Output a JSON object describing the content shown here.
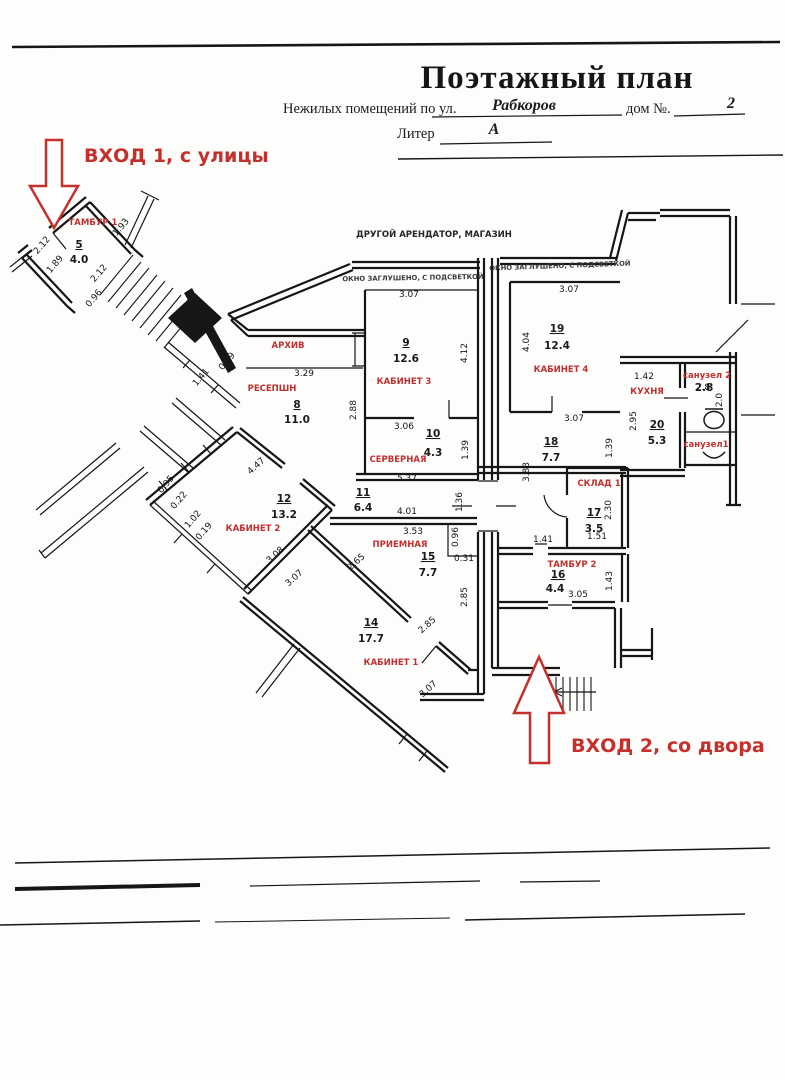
{
  "title_block": {
    "title": "Поэтажный план",
    "line1_prefix": "Нежилых помещений по ул.",
    "street": "Рабкоров",
    "house_label": "дом №.",
    "house_number": "2",
    "liter_label": "Литер",
    "liter_value": "А"
  },
  "entrance_notes": [
    {
      "id": "entrance-1",
      "text": "ВХОД 1, с улицы"
    },
    {
      "id": "entrance-2",
      "text": "ВХОД 2, со двора"
    }
  ],
  "plan_notes": [
    "ДРУГОЙ АРЕНДАТОР, МАГАЗИН",
    "ОКНО ЗАГЛУШЕНО, С ПОДСВЕТКОЙ",
    "ОКНО ЗАГЛУШЕНО, С ПОДСВЕТКОЙ"
  ],
  "rooms": [
    {
      "name": "ТАМБУР 1",
      "number": "5",
      "area": "4.0"
    },
    {
      "name": "АРХИВ",
      "number": "",
      "area": ""
    },
    {
      "name": "РЕСЕПШН",
      "number": "8",
      "area": "11.0"
    },
    {
      "name": "КАБИНЕТ 3",
      "number": "9",
      "area": "12.6"
    },
    {
      "name": "СЕРВЕРНАЯ",
      "number": "10",
      "area": "4.3"
    },
    {
      "name": "КАБИНЕТ 4",
      "number": "19",
      "area": "12.4"
    },
    {
      "name": "",
      "number": "18",
      "area": "7.7"
    },
    {
      "name": "КУХНЯ",
      "number": "20",
      "area": "5.3"
    },
    {
      "name": "санузел 2",
      "number": "",
      "area": "2.8"
    },
    {
      "name": "санузел1",
      "number": "",
      "area": ""
    },
    {
      "name": "СКЛАД 1",
      "number": "17",
      "area": "3.5"
    },
    {
      "name": "ТАМБУР 2",
      "number": "16",
      "area": "4.4"
    },
    {
      "name": "КАБИНЕТ 2",
      "number": "12",
      "area": "13.2"
    },
    {
      "name": "",
      "number": "11",
      "area": "6.4"
    },
    {
      "name": "ПРИЕМНАЯ",
      "number": "15",
      "area": "7.7"
    },
    {
      "name": "КАБИНЕТ 1",
      "number": "14",
      "area": "17.7"
    }
  ],
  "dimensions": [
    "2.12",
    "1.93",
    "1.89",
    "2.12",
    "0.96",
    "1.41",
    "0.69",
    "3.29",
    "2.88",
    "3.07",
    "4.12",
    "3.06",
    "1.39",
    "5.37",
    "3.07",
    "4.04",
    "3.07",
    "1.39",
    "3.83",
    "1.36",
    "1.42",
    "2.95",
    "2.8",
    "2.0",
    "4.01",
    "3.53",
    "0.96",
    "0.31",
    "2.85",
    "2.65",
    "2.85",
    "3.07",
    "4.47",
    "0.95",
    "0.22",
    "1.02",
    "0.19",
    "3.08",
    "3.07",
    "2.30",
    "1.51",
    "1.41",
    "3.05",
    "1.43"
  ]
}
